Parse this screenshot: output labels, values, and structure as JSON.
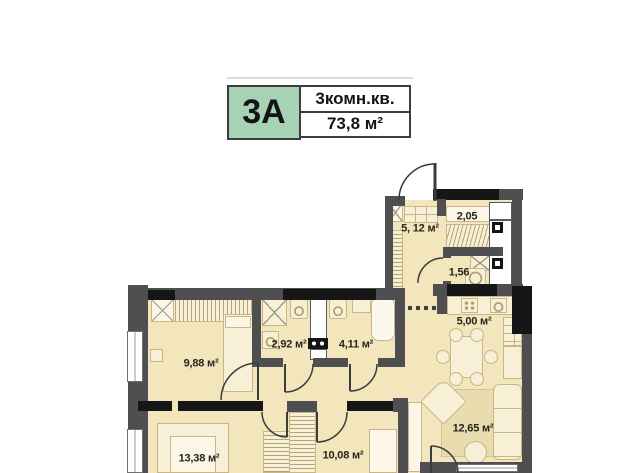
{
  "badge": {
    "unit": "3A",
    "type_label": "3комн.кв.",
    "area_label": "73,8 м²"
  },
  "colors": {
    "badge_green": "#a7d2b4",
    "wall_gray": "#4f4f51",
    "wall_black": "#161616",
    "floor_cream": "#f3e5bc",
    "furniture_fill": "#f7efd6"
  },
  "rooms": [
    {
      "id": "hallway",
      "area": "5, 12 м²"
    },
    {
      "id": "closet",
      "area": "2,05"
    },
    {
      "id": "bathroom-small",
      "area": "1,56"
    },
    {
      "id": "kitchen",
      "area": "5,00 м²"
    },
    {
      "id": "bathroom-1",
      "area": "2,92 м²"
    },
    {
      "id": "bathroom-2",
      "area": "4,11 м²"
    },
    {
      "id": "bedroom-1",
      "area": "9,88 м²"
    },
    {
      "id": "bedroom-2",
      "area": "13,38 м²"
    },
    {
      "id": "bedroom-3",
      "area": "10,08 м²"
    },
    {
      "id": "living-room",
      "area": "12,65 м²"
    }
  ]
}
